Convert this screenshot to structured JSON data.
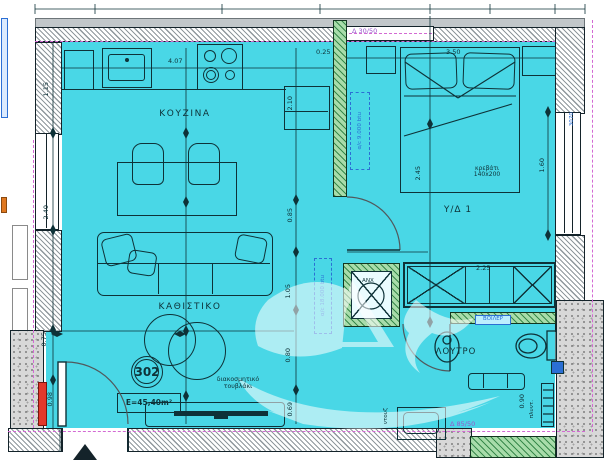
{
  "plan": {
    "title": "apartment-floor-plan",
    "rooms": {
      "kitchen": "ΚΟΥΖΙΝΑ",
      "living": "ΚΑΘΙΣΤΙΚΟ",
      "bedroom": "Υ/Δ 1",
      "bathroom": "ΛΟΥΤΡΟ"
    },
    "unit": {
      "number": "302",
      "area": "E=45,40m²"
    },
    "labels": {
      "bed_line1": "κρεβάτι",
      "bed_line2": "140x200",
      "ac_bedroom": "α/c 9.000 btu",
      "ac_living": "α/c 18.000 btu",
      "shaft": "ANX",
      "shower": "ντουζ",
      "washer": "πλυντ.",
      "boiler": "ΒΟΙΛΕΡ",
      "beam_top": "Δ 30/50",
      "beam_bath": "Δ 85/50",
      "brick_line1": "διακοσμητικό",
      "brick_line2": "τουβλάκι",
      "window_code": "3070"
    },
    "dimensions": {
      "kitchen_width": "4.07",
      "d115": "1.15",
      "d240": "2.40",
      "d075": "0.75",
      "d098": "0.98",
      "d210": "2.10",
      "d085": "0.85",
      "d105": "1.05",
      "d080": "0.80",
      "d069": "0.69",
      "bed_width": "3.50",
      "bed_length": "2.45",
      "d025": "0.25",
      "window_right": "1.60",
      "wardrobe": "2.25",
      "towel_rail": "0.90"
    },
    "colors": {
      "room_fill": "#49d7e6",
      "wall_line": "#14232a",
      "green_partition": "#a8dcaa",
      "boundary_dashed": "#d369d3",
      "beam_text": "#9a55cc",
      "accent_blue": "#2b6fd4",
      "alert_red": "#e2382b",
      "stone": "#d8d8d8"
    }
  }
}
